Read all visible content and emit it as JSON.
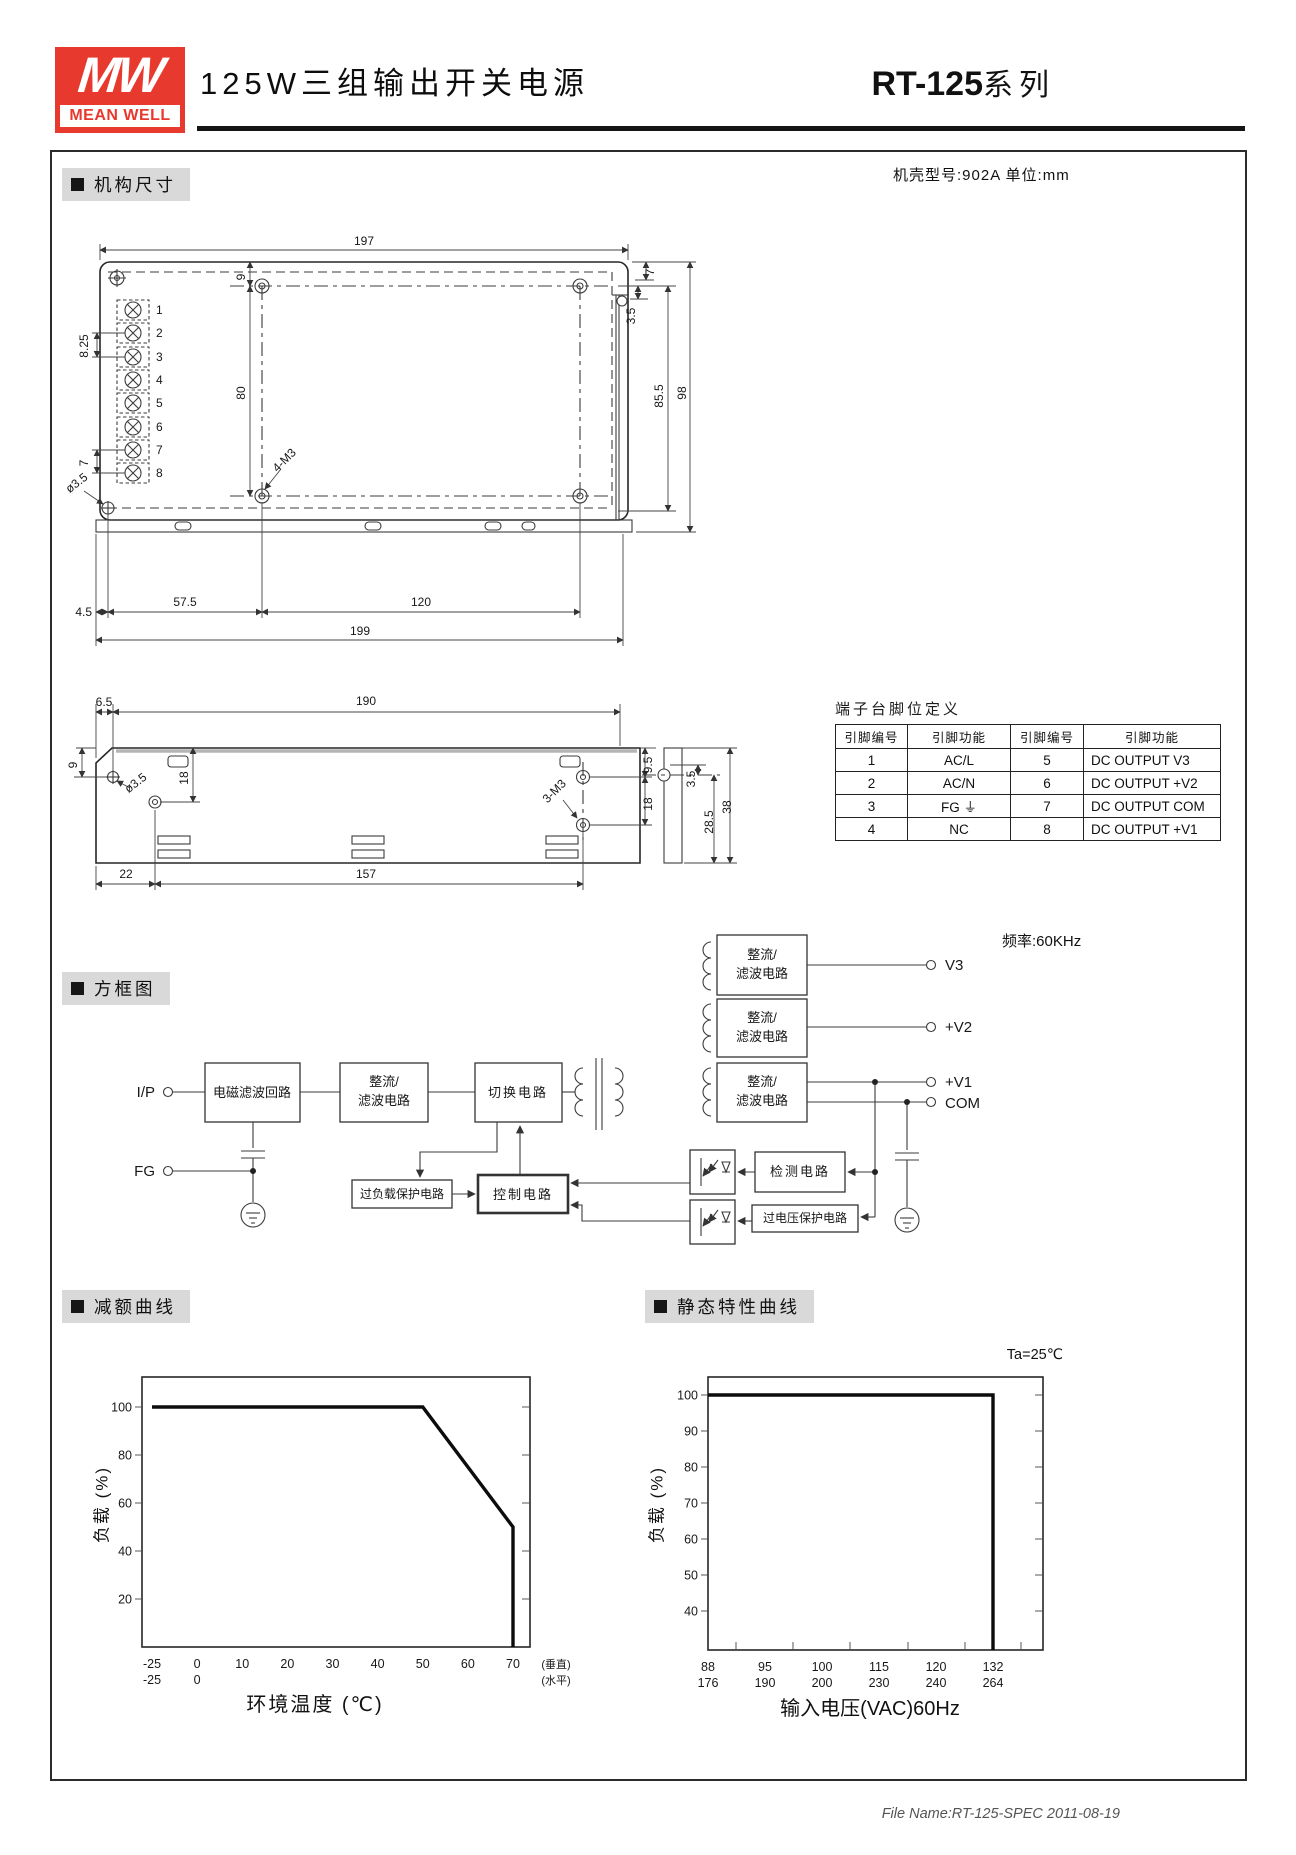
{
  "header": {
    "logo": {
      "mw": "MW",
      "brand": "MEAN WELL",
      "red": "#e8392e"
    },
    "title": "125W三组输出开关电源",
    "series_bold": "RT-125",
    "series_rest": "系列"
  },
  "sections": {
    "mech": "机构尺寸",
    "block": "方框图",
    "derating": "减额曲线",
    "static": "静态特性曲线"
  },
  "mech": {
    "case_note": "机壳型号:902A 单位:mm"
  },
  "block": {
    "freq": "频率:60KHz"
  },
  "footer": {
    "text": "File Name:RT-125-SPEC  2011-08-19"
  },
  "pin_table": {
    "caption": "端子台脚位定义",
    "headers": [
      "引脚编号",
      "引脚功能",
      "引脚编号",
      "引脚功能"
    ],
    "rows": [
      [
        "1",
        "AC/L",
        "5",
        "DC OUTPUT V3"
      ],
      [
        "2",
        "AC/N",
        "6",
        "DC OUTPUT +V2"
      ],
      [
        "3",
        "FG ⏚",
        "7",
        "DC OUTPUT COM"
      ],
      [
        "4",
        "NC",
        "8",
        "DC OUTPUT +V1"
      ]
    ]
  },
  "chart_data": [
    {
      "type": "line",
      "title": "减额曲线",
      "xlabel": "环境温度 (℃)",
      "ylabel": "负载 (%)",
      "x_ticks": [
        "-25",
        "0",
        "10",
        "20",
        "30",
        "40",
        "50",
        "60",
        "70"
      ],
      "x_ticks_row2": [
        "-25",
        "0"
      ],
      "x_axis_notes": [
        "(垂直)",
        "(水平)"
      ],
      "y_ticks": [
        100,
        80,
        60,
        40,
        20
      ],
      "ylim": [
        0,
        112
      ],
      "grid": false,
      "points": [
        [
          -25,
          100
        ],
        [
          50,
          100
        ],
        [
          70,
          50
        ],
        [
          70,
          0
        ]
      ]
    },
    {
      "type": "line",
      "title": "静态特性曲线",
      "condition": "Ta=25℃",
      "xlabel": "输入电压(VAC)60Hz",
      "ylabel": "负载 (%)",
      "x_ticks": [
        "88",
        "95",
        "100",
        "115",
        "120",
        "132"
      ],
      "x_ticks_row2": [
        "176",
        "190",
        "200",
        "230",
        "240",
        "264"
      ],
      "y_ticks": [
        100,
        90,
        80,
        70,
        60,
        50,
        40
      ],
      "ylim": [
        30,
        105
      ],
      "grid": false,
      "points": [
        [
          88,
          100
        ],
        [
          132,
          100
        ],
        [
          132,
          0
        ]
      ]
    }
  ],
  "ann": {
    "mech_top": [
      {
        "x": 364,
        "y": 245,
        "t": "197"
      },
      {
        "x": 245,
        "y": 277,
        "t": "9",
        "r": -90
      },
      {
        "x": 245,
        "y": 393,
        "t": "80",
        "r": -90
      },
      {
        "x": 88,
        "y": 346,
        "t": "8.25",
        "r": -90
      },
      {
        "x": 88,
        "y": 463,
        "t": "7",
        "r": -90
      },
      {
        "x": 156,
        "y": 314,
        "t": "1",
        "a": "start"
      },
      {
        "x": 156,
        "y": 337,
        "t": "2",
        "a": "start"
      },
      {
        "x": 156,
        "y": 361,
        "t": "3",
        "a": "start"
      },
      {
        "x": 156,
        "y": 384,
        "t": "4",
        "a": "start"
      },
      {
        "x": 156,
        "y": 407,
        "t": "5",
        "a": "start"
      },
      {
        "x": 156,
        "y": 431,
        "t": "6",
        "a": "start"
      },
      {
        "x": 156,
        "y": 454,
        "t": "7",
        "a": "start"
      },
      {
        "x": 156,
        "y": 477,
        "t": "8",
        "a": "start"
      },
      {
        "x": 79,
        "y": 486,
        "t": "ø3.5",
        "r": -38
      },
      {
        "x": 287,
        "y": 463,
        "t": "4-M3",
        "r": -45
      },
      {
        "x": 654,
        "y": 272,
        "t": "7",
        "r": -90
      },
      {
        "x": 635,
        "y": 316,
        "t": "3.5",
        "r": -90
      },
      {
        "x": 663,
        "y": 396,
        "t": "85.5",
        "r": -90
      },
      {
        "x": 686,
        "y": 393,
        "t": "98",
        "r": -90
      },
      {
        "x": 92,
        "y": 616,
        "t": "4.5",
        "a": "end"
      },
      {
        "x": 185,
        "y": 606,
        "t": "57.5"
      },
      {
        "x": 421,
        "y": 606,
        "t": "120"
      },
      {
        "x": 360,
        "y": 635,
        "t": "199"
      }
    ],
    "mech_side": [
      {
        "x": 104,
        "y": 706,
        "t": "6.5"
      },
      {
        "x": 366,
        "y": 705,
        "t": "190"
      },
      {
        "x": 77,
        "y": 765,
        "t": "9",
        "r": -90
      },
      {
        "x": 138,
        "y": 786,
        "t": "ø3.5",
        "r": -38
      },
      {
        "x": 188,
        "y": 778,
        "t": "18",
        "r": -90
      },
      {
        "x": 652,
        "y": 765,
        "t": "9.5",
        "r": -90
      },
      {
        "x": 652,
        "y": 804,
        "t": "18",
        "r": -90
      },
      {
        "x": 557,
        "y": 794,
        "t": "3-M3",
        "r": -45
      },
      {
        "x": 695,
        "y": 779,
        "t": "3.5",
        "r": -90
      },
      {
        "x": 713,
        "y": 822,
        "t": "28.5",
        "r": -90
      },
      {
        "x": 731,
        "y": 807,
        "t": "38",
        "r": -90
      },
      {
        "x": 126,
        "y": 878,
        "t": "22"
      },
      {
        "x": 366,
        "y": 878,
        "t": "157"
      }
    ],
    "block": [
      {
        "x": 155,
        "y": 1097,
        "t": "I/P",
        "s": 15,
        "a": "end"
      },
      {
        "x": 155,
        "y": 1176,
        "t": "FG",
        "s": 15,
        "a": "end"
      },
      {
        "x": 252,
        "y": 1097,
        "t": "电磁滤波回路",
        "s": 13
      },
      {
        "x": 384,
        "y": 1086,
        "t": "整流/",
        "s": 13
      },
      {
        "x": 384,
        "y": 1105,
        "t": "滤波电路",
        "s": 13
      },
      {
        "x": 518,
        "y": 1097,
        "t": "切换电路",
        "s": 13,
        "ls": 2
      },
      {
        "x": 762,
        "y": 959,
        "t": "整流/",
        "s": 13
      },
      {
        "x": 762,
        "y": 978,
        "t": "滤波电路",
        "s": 13
      },
      {
        "x": 762,
        "y": 1022,
        "t": "整流/",
        "s": 13
      },
      {
        "x": 762,
        "y": 1041,
        "t": "滤波电路",
        "s": 13
      },
      {
        "x": 762,
        "y": 1086,
        "t": "整流/",
        "s": 13
      },
      {
        "x": 762,
        "y": 1105,
        "t": "滤波电路",
        "s": 13
      },
      {
        "x": 945,
        "y": 970,
        "t": "V3",
        "s": 15,
        "a": "start"
      },
      {
        "x": 945,
        "y": 1032,
        "t": "+V2",
        "s": 15,
        "a": "start"
      },
      {
        "x": 945,
        "y": 1087,
        "t": "+V1",
        "s": 15,
        "a": "start"
      },
      {
        "x": 945,
        "y": 1108,
        "t": "COM",
        "s": 15,
        "a": "start"
      },
      {
        "x": 402,
        "y": 1198,
        "t": "过负载保护电路",
        "s": 12
      },
      {
        "x": 523,
        "y": 1199,
        "t": "控制电路",
        "s": 13,
        "ls": 2
      },
      {
        "x": 800,
        "y": 1176,
        "t": "检测电路",
        "s": 13,
        "ls": 2
      },
      {
        "x": 805,
        "y": 1222,
        "t": "过电压保护电路",
        "s": 12
      }
    ]
  }
}
